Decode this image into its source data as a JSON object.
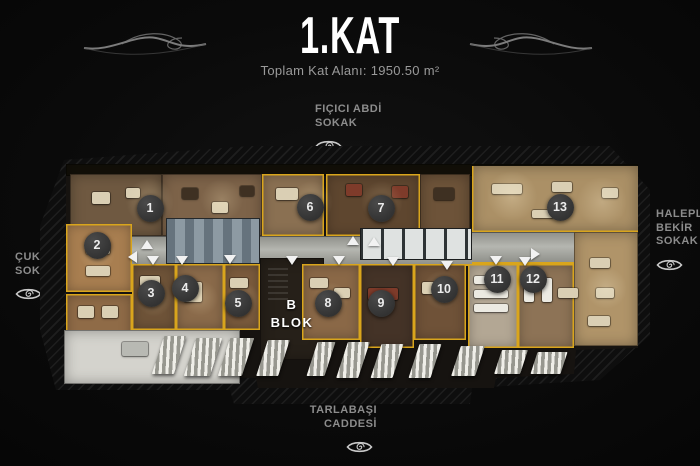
{
  "header": {
    "title": "1.KAT",
    "subtitle": "Toplam Kat Alanı: 1950.50 m²"
  },
  "streets": {
    "top": {
      "lines": [
        "FIÇICI ABDİ",
        "SOKAK"
      ]
    },
    "left": {
      "lines": [
        "ÇUKUR",
        "SOKAK"
      ]
    },
    "right": {
      "lines": [
        "HALEPLİ",
        "BEKİR",
        "SOKAK"
      ]
    },
    "bottom": {
      "lines": [
        "TARLABAŞI",
        "CADDESİ"
      ]
    }
  },
  "plan": {
    "block_label": {
      "line1": "B",
      "line2": "BLOK"
    },
    "rooms": [
      {
        "number": "1",
        "x": 88,
        "y": 50
      },
      {
        "number": "2",
        "x": 35,
        "y": 87
      },
      {
        "number": "3",
        "x": 89,
        "y": 135
      },
      {
        "number": "4",
        "x": 123,
        "y": 130
      },
      {
        "number": "5",
        "x": 176,
        "y": 145
      },
      {
        "number": "6",
        "x": 248,
        "y": 49
      },
      {
        "number": "7",
        "x": 319,
        "y": 50
      },
      {
        "number": "8",
        "x": 266,
        "y": 145
      },
      {
        "number": "9",
        "x": 319,
        "y": 145
      },
      {
        "number": "10",
        "x": 382,
        "y": 131
      },
      {
        "number": "11",
        "x": 435,
        "y": 121
      },
      {
        "number": "12",
        "x": 471,
        "y": 121
      },
      {
        "number": "13",
        "x": 498,
        "y": 49
      }
    ],
    "doors": [
      {
        "x": 85,
        "y": 88,
        "dir": "up"
      },
      {
        "x": 291,
        "y": 84,
        "dir": "up"
      },
      {
        "x": 312,
        "y": 85,
        "dir": "up"
      },
      {
        "x": 72,
        "y": 99,
        "dir": "left"
      },
      {
        "x": 91,
        "y": 104,
        "dir": "down"
      },
      {
        "x": 120,
        "y": 104,
        "dir": "down"
      },
      {
        "x": 168,
        "y": 103,
        "dir": "down"
      },
      {
        "x": 230,
        "y": 104,
        "dir": "down"
      },
      {
        "x": 277,
        "y": 104,
        "dir": "down"
      },
      {
        "x": 331,
        "y": 105,
        "dir": "down"
      },
      {
        "x": 385,
        "y": 109,
        "dir": "down"
      },
      {
        "x": 434,
        "y": 104,
        "dir": "down"
      },
      {
        "x": 463,
        "y": 105,
        "dir": "down"
      },
      {
        "x": 475,
        "y": 96,
        "dir": "right"
      }
    ]
  },
  "colors": {
    "background": "#0b0b0b",
    "accent_wall_yellow": "#d9a51c",
    "label_gray": "#8c8c8c",
    "title_white": "#ffffff",
    "marker_circle": "#3a3a3a"
  },
  "icons": {
    "eye": "eye-icon",
    "flourish": "flourish-swirl"
  }
}
